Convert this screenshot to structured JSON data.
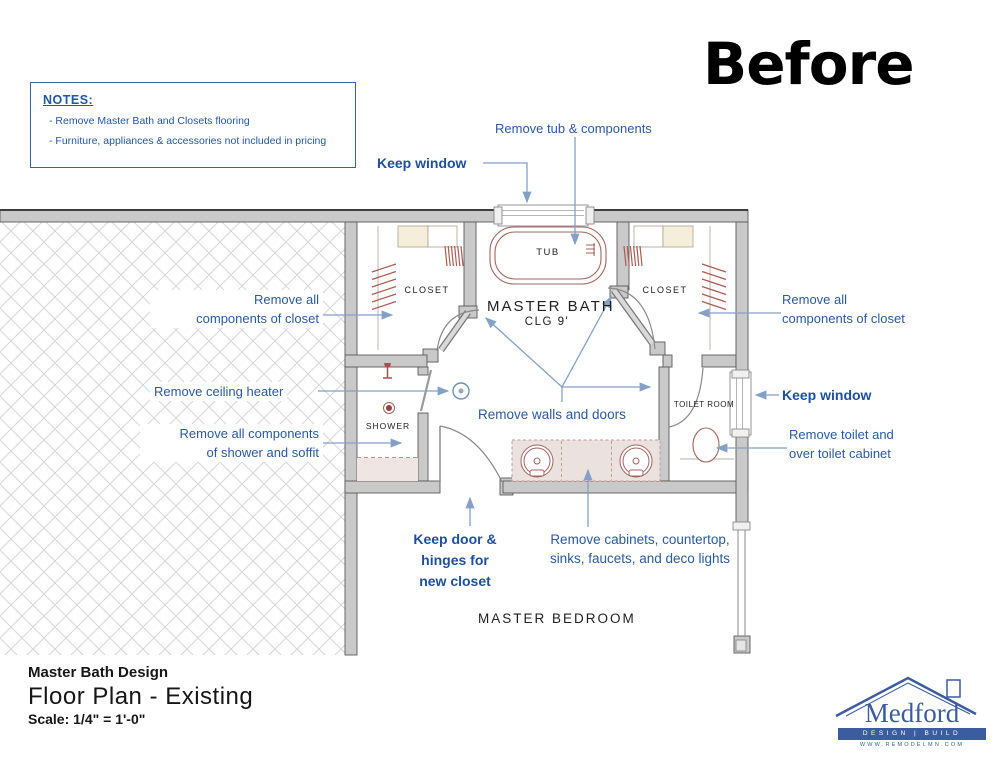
{
  "header": {
    "before_label": "Before"
  },
  "notes": {
    "heading": "NOTES:",
    "item1": "- Remove Master Bath and Closets flooring",
    "item2": "- Furniture, appliances & accessories not included in pricing"
  },
  "callouts": {
    "remove_tub": "Remove tub & components",
    "keep_window_top": "Keep window",
    "remove_closet_left_1": "Remove all",
    "remove_closet_left_2": "components of closet",
    "remove_heater": "Remove ceiling heater",
    "remove_shower_1": "Remove all components",
    "remove_shower_2": "of shower and soffit",
    "remove_walls": "Remove walls and doors",
    "remove_closet_right_1": "Remove all",
    "remove_closet_right_2": "components of closet",
    "keep_window_right": "Keep window",
    "remove_toilet_1": "Remove toilet and",
    "remove_toilet_2": "over toilet cabinet",
    "keep_door_1": "Keep door &",
    "keep_door_2": "hinges for",
    "keep_door_3": "new closet",
    "remove_cabinets_1": "Remove cabinets, countertop,",
    "remove_cabinets_2": "sinks, faucets, and deco lights"
  },
  "rooms": {
    "closet_left": "CLOSET",
    "closet_right": "CLOSET",
    "master_bath": "MASTER BATH",
    "ceiling": "CLG 9'",
    "tub": "TUB",
    "shower": "SHOWER",
    "toilet_room": "TOILET ROOM",
    "master_bedroom": "MASTER BEDROOM"
  },
  "title_block": {
    "project": "Master Bath Design",
    "sheet": "Floor Plan - Existing",
    "scale": "Scale: 1/4\" = 1'-0\""
  },
  "logo": {
    "name": "Medford",
    "tagline": "DESIGN | BUILD",
    "url": "WWW.REMODELMN.COM"
  },
  "colors": {
    "annotation_blue": "#2a5aa0",
    "annotation_bold_blue": "#1d4f9c",
    "arrow_blue": "#85a0c6",
    "wall_fill": "#c9c9c9",
    "wall_stroke": "#5a5a5a",
    "fixture_brown": "#a2645d",
    "logo_blue": "#3b5c9e"
  }
}
